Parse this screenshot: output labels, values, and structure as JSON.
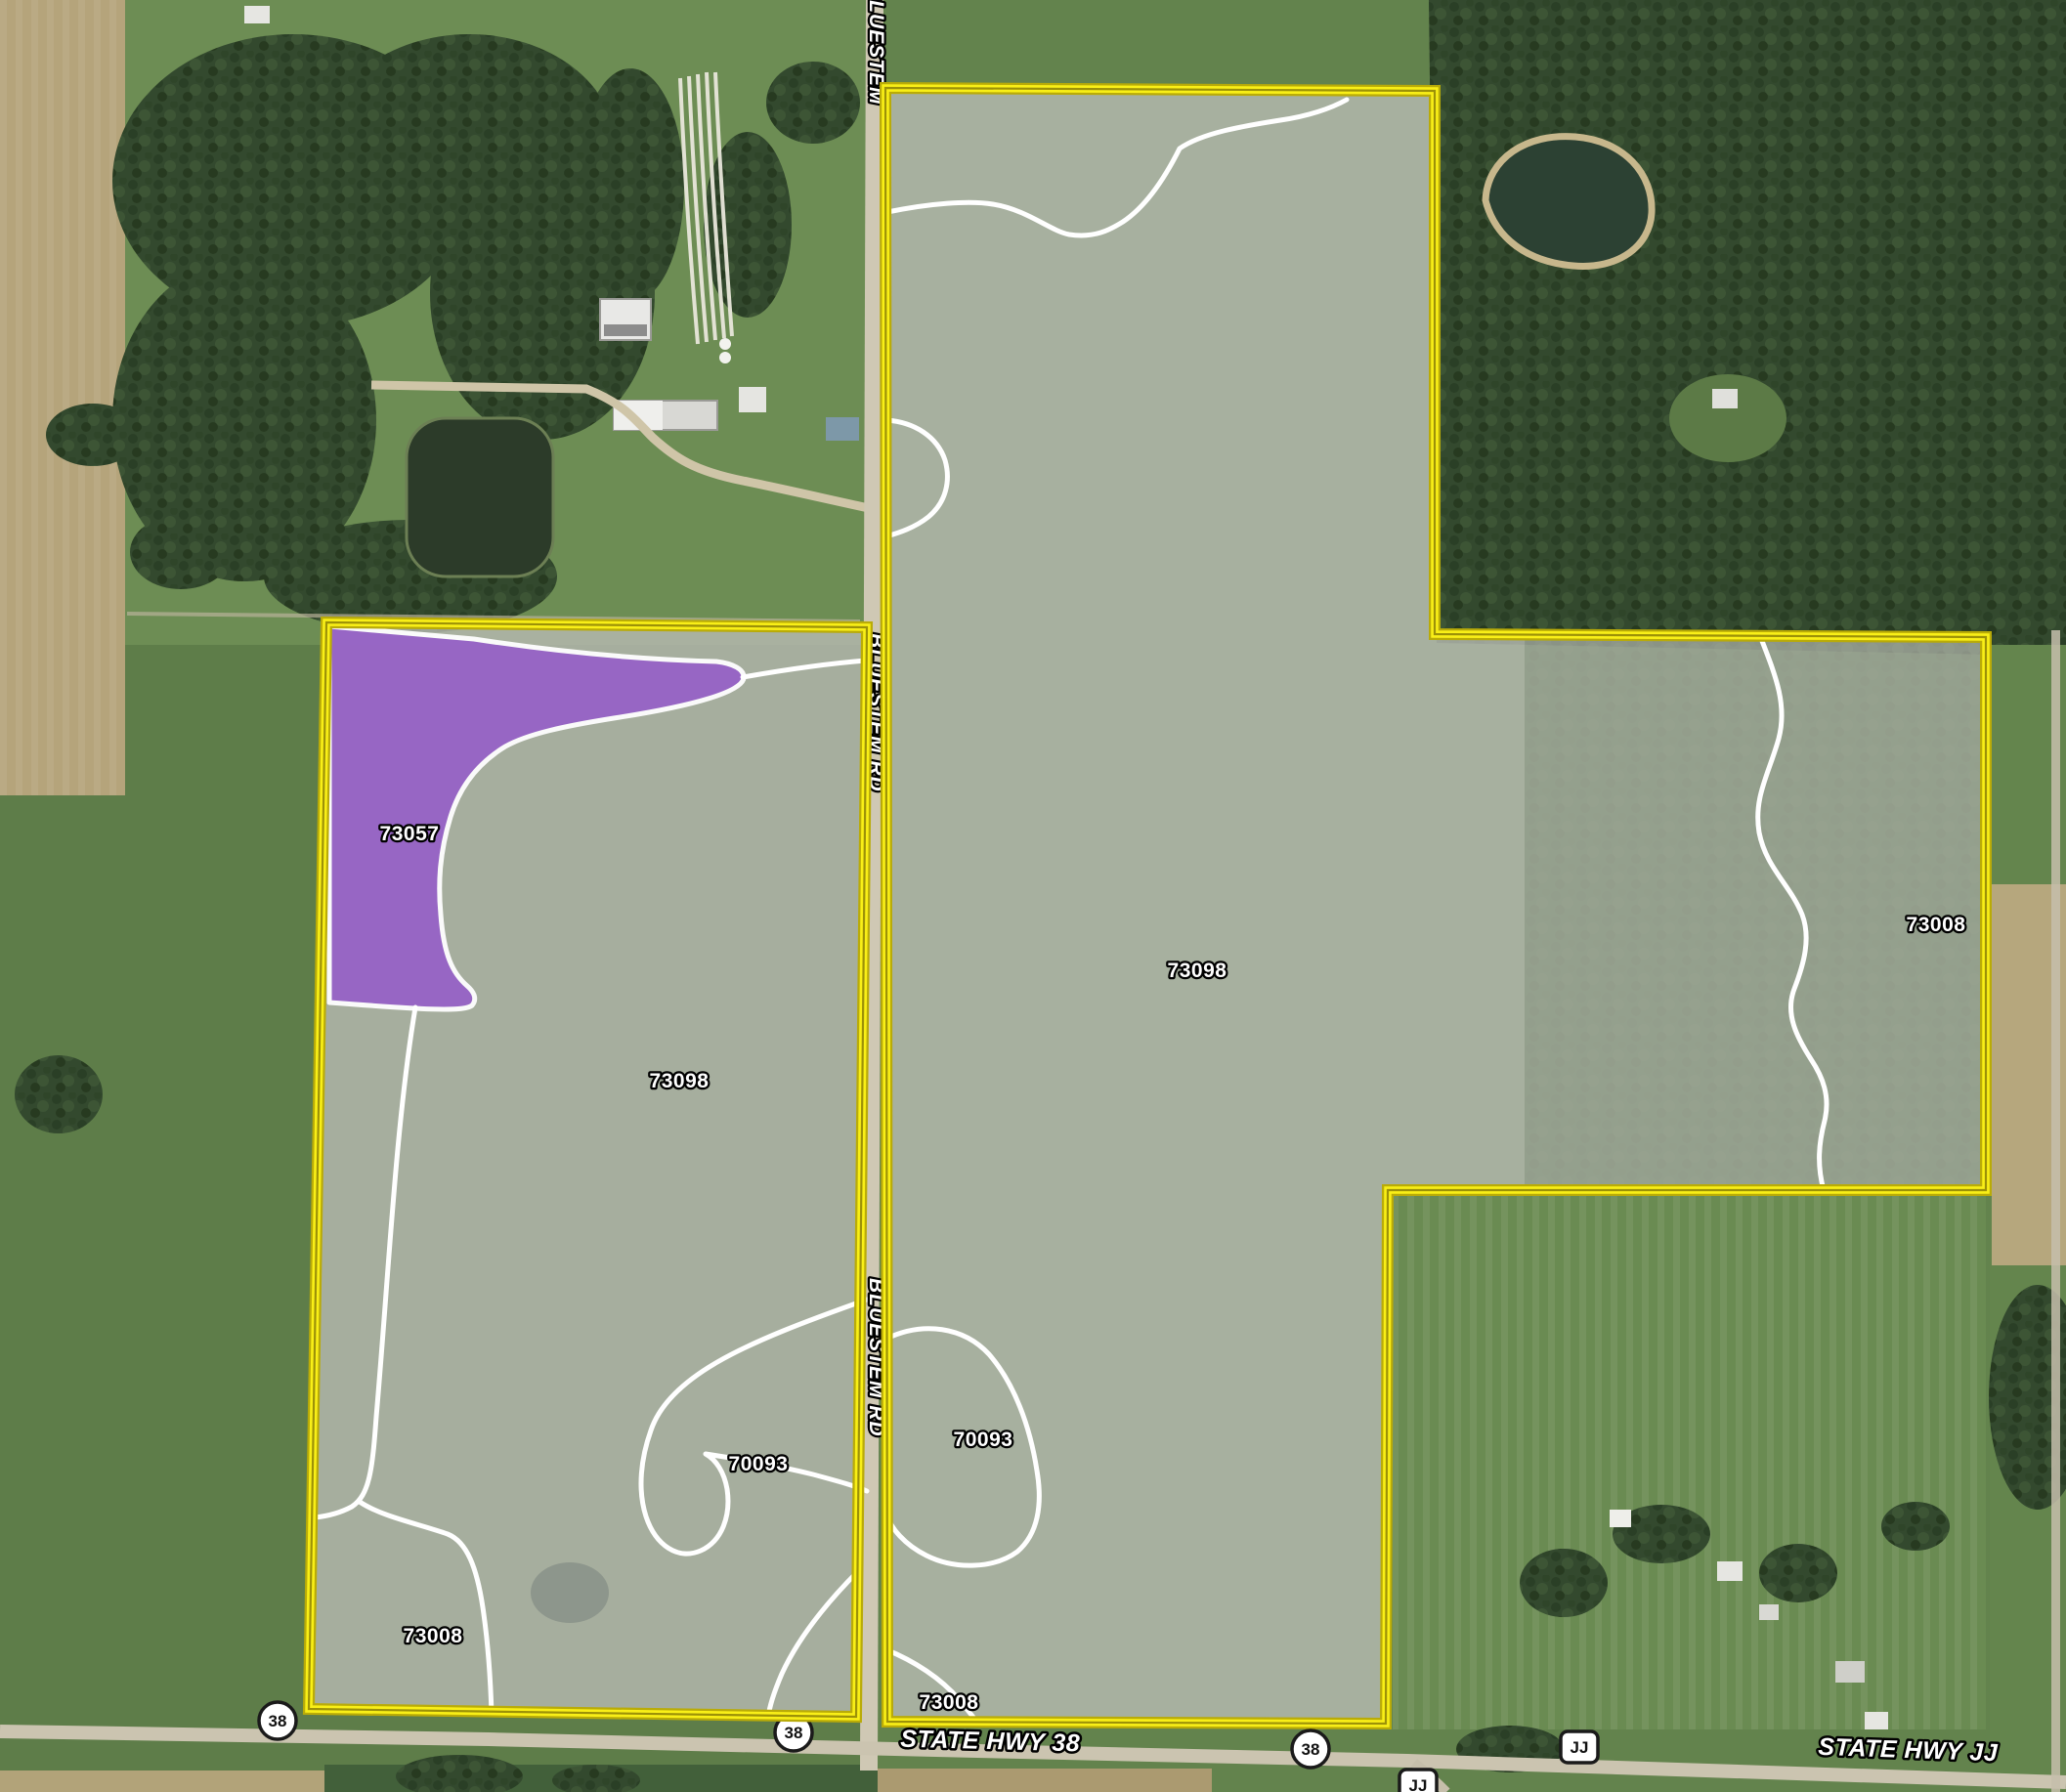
{
  "map": {
    "soil_labels": [
      {
        "code": "73057"
      },
      {
        "code": "73098"
      },
      {
        "code": "73098"
      },
      {
        "code": "73008"
      },
      {
        "code": "70093"
      },
      {
        "code": "70093"
      },
      {
        "code": "73008"
      },
      {
        "code": "73008"
      }
    ],
    "road_names": {
      "vertical_top": "BLUESTEM",
      "vertical_mid": "BLUESTEM RD",
      "vertical_low": "BLUESTEM RD",
      "highway_38": "STATE HWY 38",
      "highway_jj": "STATE HWY JJ"
    },
    "shields": [
      {
        "shape": "circle",
        "label": "38"
      },
      {
        "shape": "circle",
        "label": "38"
      },
      {
        "shape": "circle",
        "label": "38"
      },
      {
        "shape": "rounded-square",
        "label": "JJ"
      },
      {
        "shape": "rounded-square",
        "label": "JJ"
      }
    ],
    "colors": {
      "parcel_boundary": "#f9ef17",
      "soil_zone_highlight": "#9763c7",
      "soil_line": "#ffffff",
      "parcel_overlay": "#b6bab1"
    }
  }
}
